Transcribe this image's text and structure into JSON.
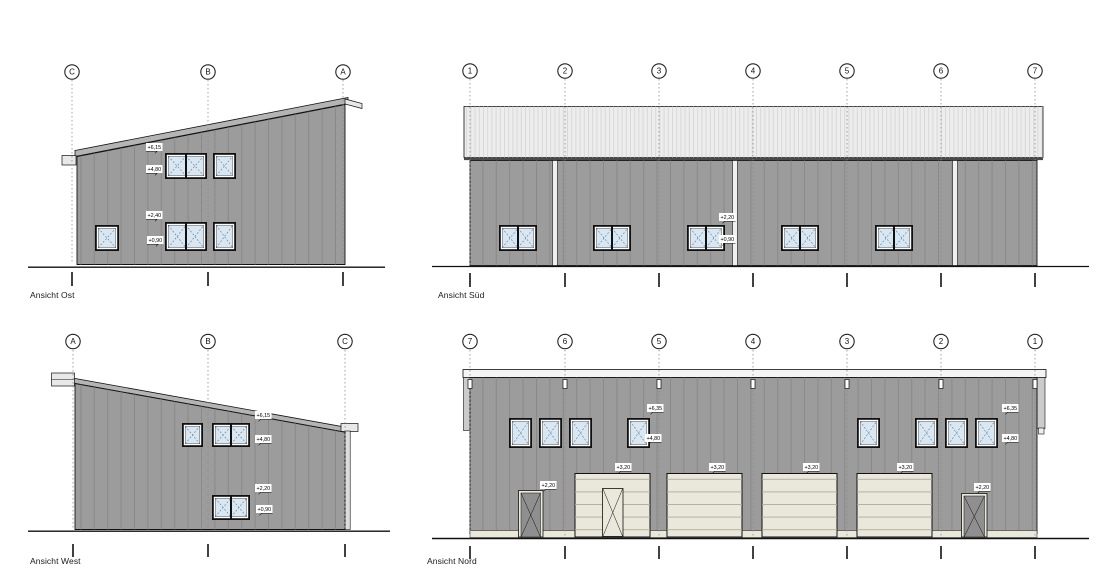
{
  "drawing": {
    "type": "architectural-elevations",
    "views": {
      "ost": {
        "title": "Ansicht Ost",
        "grid_labels": [
          "C",
          "B",
          "A"
        ],
        "dims": [
          "+6,15",
          "+4,80",
          "+2,40",
          "+0,90"
        ]
      },
      "sued": {
        "title": "Ansicht Süd",
        "grid_labels": [
          "1",
          "2",
          "3",
          "4",
          "5",
          "6",
          "7"
        ],
        "dims": [
          "+2,20",
          "+0,90"
        ]
      },
      "west": {
        "title": "Ansicht West",
        "grid_labels": [
          "A",
          "B",
          "C"
        ],
        "dims": [
          "+6,15",
          "+4,80",
          "+2,20",
          "+0,90"
        ]
      },
      "nord": {
        "title": "Ansicht Nord",
        "grid_labels": [
          "7",
          "6",
          "5",
          "4",
          "3",
          "2",
          "1"
        ],
        "dims": [
          "+6,35",
          "+4,80",
          "+6,35",
          "+4,80",
          "+3,20",
          "+3,20",
          "+3,20",
          "+3,20",
          "+2,20",
          "+2,20"
        ]
      }
    },
    "colors": {
      "wall": "#9c9c9c",
      "roof_band": "#ededed",
      "roof_edge": "#b4b4b4",
      "glass": "#d9e7f2",
      "door_panel": "#eae7db",
      "door_leaf": "#8f8f8f"
    }
  }
}
